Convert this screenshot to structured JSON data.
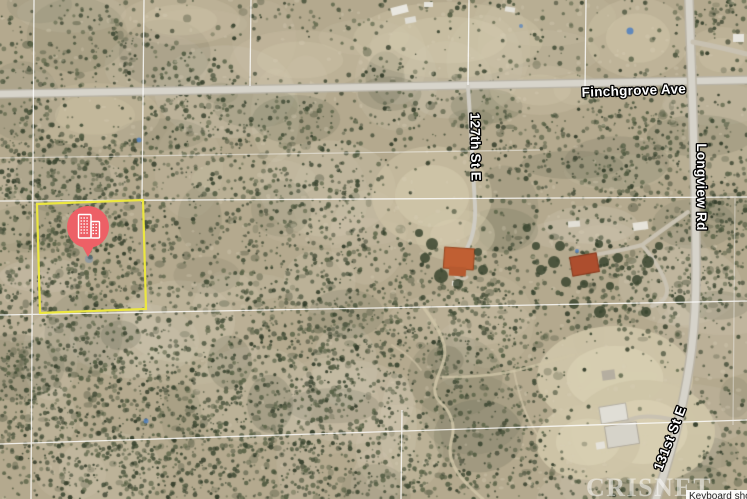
{
  "map": {
    "type": "satellite",
    "road_labels": [
      {
        "id": "finchgrove",
        "label": "Finchgrove Ave"
      },
      {
        "id": "127th",
        "label": "127th St E"
      },
      {
        "id": "longview",
        "label": "Longview Rd"
      },
      {
        "id": "131st",
        "label": "131st St E"
      }
    ],
    "parcel": {
      "highlight_color": "#ece73f"
    },
    "marker": {
      "icon": "buildings-icon",
      "color": "#ed6066"
    },
    "watermark": {
      "text": "CRISNET"
    },
    "attribution": {
      "text": "Keyboard shortcuts"
    }
  }
}
